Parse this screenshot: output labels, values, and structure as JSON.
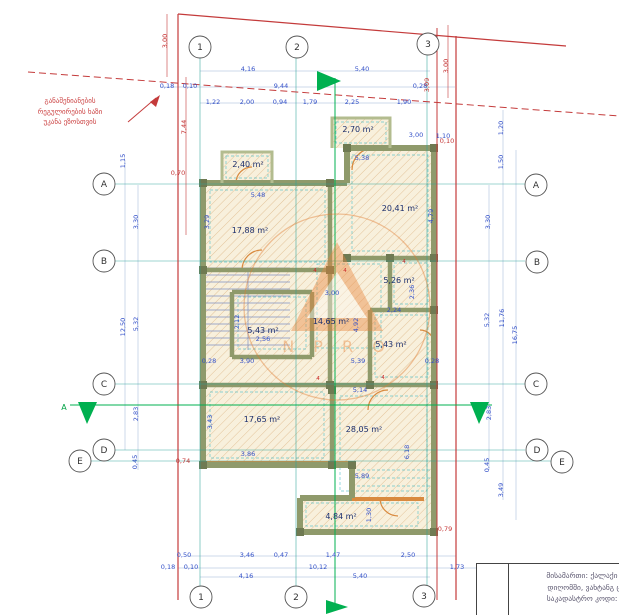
{
  "annotation": {
    "line1": "განაშენიანების",
    "line2": "რეგულირების ხაზი",
    "line3": "უკანა ეზოსთვის"
  },
  "title_block": {
    "line1": "მისამართი: ქალაქი თბილ",
    "line2": "დიღომში, ვახტანგ ცინცაძ",
    "line3": "საკადასტრო კოდი: 01.72"
  },
  "watermark": {
    "letters": "N P R O"
  },
  "section_marker": {
    "label": "A"
  },
  "colors": {
    "dimension_blue": "#3350c8",
    "room_label": "#1c2f6e",
    "boundary_red": "#c43b3b",
    "grid_teal": "#2aa198",
    "section_green": "#00b050",
    "door_orange": "#d98a3f",
    "wall_olive": "#8f9a6b",
    "watermark_orange": "#e8833a"
  },
  "grid_bubbles": [
    {
      "label": "1",
      "x": 200,
      "y": 47
    },
    {
      "label": "2",
      "x": 297,
      "y": 47
    },
    {
      "label": "3",
      "x": 428,
      "y": 44
    },
    {
      "label": "1",
      "x": 201,
      "y": 597
    },
    {
      "label": "2",
      "x": 296,
      "y": 597
    },
    {
      "label": "3",
      "x": 424,
      "y": 596
    },
    {
      "label": "A",
      "x": 104,
      "y": 184
    },
    {
      "label": "B",
      "x": 104,
      "y": 261
    },
    {
      "label": "C",
      "x": 104,
      "y": 384
    },
    {
      "label": "D",
      "x": 104,
      "y": 450
    },
    {
      "label": "E",
      "x": 80,
      "y": 461
    },
    {
      "label": "A",
      "x": 536,
      "y": 185
    },
    {
      "label": "B",
      "x": 537,
      "y": 262
    },
    {
      "label": "C",
      "x": 536,
      "y": 384
    },
    {
      "label": "D",
      "x": 537,
      "y": 450
    },
    {
      "label": "E",
      "x": 562,
      "y": 462
    }
  ],
  "room_labels": [
    {
      "t": "2,40 m²",
      "x": 248,
      "y": 167
    },
    {
      "t": "2,70 m²",
      "x": 358,
      "y": 132
    },
    {
      "t": "20,41 m²",
      "x": 400,
      "y": 211
    },
    {
      "t": "17,88 m²",
      "x": 250,
      "y": 233
    },
    {
      "t": "5,26 m²",
      "x": 399,
      "y": 283
    },
    {
      "t": "14,65 m²",
      "x": 331,
      "y": 324
    },
    {
      "t": "5,43 m²",
      "x": 263,
      "y": 333
    },
    {
      "t": "5,43 m²",
      "x": 391,
      "y": 347
    },
    {
      "t": "17,65 m²",
      "x": 262,
      "y": 422
    },
    {
      "t": "28,05 m²",
      "x": 364,
      "y": 432
    },
    {
      "t": "4,84 m²",
      "x": 341,
      "y": 519
    }
  ],
  "dimensions_blue": [
    {
      "t": "4,16",
      "x": 248,
      "y": 71
    },
    {
      "t": "5,40",
      "x": 362,
      "y": 71
    },
    {
      "t": "0,18",
      "x": 167,
      "y": 88
    },
    {
      "t": "0,10",
      "x": 190,
      "y": 88
    },
    {
      "t": "9,44",
      "x": 281,
      "y": 88
    },
    {
      "t": "0,28",
      "x": 420,
      "y": 88
    },
    {
      "t": "1,22",
      "x": 213,
      "y": 104
    },
    {
      "t": "2,00",
      "x": 247,
      "y": 104
    },
    {
      "t": "0,94",
      "x": 280,
      "y": 104
    },
    {
      "t": "1,79",
      "x": 310,
      "y": 104
    },
    {
      "t": "2,25",
      "x": 352,
      "y": 104
    },
    {
      "t": "1,90",
      "x": 404,
      "y": 104
    },
    {
      "t": "1,20",
      "x": 503,
      "y": 128,
      "r": 1
    },
    {
      "t": "1,50",
      "x": 503,
      "y": 162,
      "r": 1
    },
    {
      "t": "3,30",
      "x": 490,
      "y": 222,
      "r": 1
    },
    {
      "t": "5,32",
      "x": 489,
      "y": 320,
      "r": 1
    },
    {
      "t": "11,76",
      "x": 504,
      "y": 318,
      "r": 1
    },
    {
      "t": "16,75",
      "x": 517,
      "y": 335,
      "r": 1
    },
    {
      "t": "2,83",
      "x": 491,
      "y": 413,
      "r": 1
    },
    {
      "t": "0,45",
      "x": 489,
      "y": 465,
      "r": 1
    },
    {
      "t": "3,49",
      "x": 503,
      "y": 490,
      "r": 1
    },
    {
      "t": "1,15",
      "x": 125,
      "y": 161,
      "r": 1
    },
    {
      "t": "3,30",
      "x": 138,
      "y": 222,
      "r": 1
    },
    {
      "t": "12,50",
      "x": 125,
      "y": 327,
      "r": 1
    },
    {
      "t": "5,32",
      "x": 138,
      "y": 324,
      "r": 1
    },
    {
      "t": "2,83",
      "x": 138,
      "y": 414,
      "r": 1
    },
    {
      "t": "0,45",
      "x": 137,
      "y": 462,
      "r": 1
    },
    {
      "t": "0,50",
      "x": 184,
      "y": 557
    },
    {
      "t": "3,46",
      "x": 247,
      "y": 557
    },
    {
      "t": "0,47",
      "x": 281,
      "y": 557
    },
    {
      "t": "1,47",
      "x": 333,
      "y": 557
    },
    {
      "t": "2,50",
      "x": 408,
      "y": 557
    },
    {
      "t": "0,18",
      "x": 168,
      "y": 569
    },
    {
      "t": "0,10",
      "x": 191,
      "y": 569
    },
    {
      "t": "10,12",
      "x": 318,
      "y": 569
    },
    {
      "t": "1,73",
      "x": 457,
      "y": 569
    },
    {
      "t": "4,16",
      "x": 246,
      "y": 578
    },
    {
      "t": "5,40",
      "x": 360,
      "y": 578
    },
    {
      "t": "5,38",
      "x": 362,
      "y": 160
    },
    {
      "t": "3,00",
      "x": 416,
      "y": 137
    },
    {
      "t": "1,10",
      "x": 443,
      "y": 138
    },
    {
      "t": "5,48",
      "x": 258,
      "y": 197
    },
    {
      "t": "3,29",
      "x": 209,
      "y": 222,
      "r": 1
    },
    {
      "t": "4,79",
      "x": 433,
      "y": 216,
      "r": 1
    },
    {
      "t": "3,00",
      "x": 332,
      "y": 295
    },
    {
      "t": "2,12",
      "x": 239,
      "y": 322,
      "r": 1
    },
    {
      "t": "2,56",
      "x": 263,
      "y": 341
    },
    {
      "t": "4,92",
      "x": 358,
      "y": 325,
      "r": 1
    },
    {
      "t": "2,36",
      "x": 414,
      "y": 292,
      "r": 1
    },
    {
      "t": "2,24",
      "x": 394,
      "y": 312
    },
    {
      "t": "0,28",
      "x": 209,
      "y": 363
    },
    {
      "t": "3,90",
      "x": 247,
      "y": 363
    },
    {
      "t": "5,39",
      "x": 358,
      "y": 363
    },
    {
      "t": "0,28",
      "x": 432,
      "y": 363
    },
    {
      "t": "5,14",
      "x": 360,
      "y": 392
    },
    {
      "t": "3,43",
      "x": 212,
      "y": 422,
      "r": 1
    },
    {
      "t": "3,86",
      "x": 248,
      "y": 456
    },
    {
      "t": "5,89",
      "x": 362,
      "y": 478
    },
    {
      "t": "6,18",
      "x": 409,
      "y": 452,
      "r": 1
    },
    {
      "t": "1,30",
      "x": 371,
      "y": 515,
      "r": 1
    }
  ],
  "dimensions_red": [
    {
      "t": "3,00",
      "x": 167,
      "y": 41,
      "r": 1
    },
    {
      "t": "7,44",
      "x": 186,
      "y": 127,
      "r": 1
    },
    {
      "t": "0,70",
      "x": 178,
      "y": 175
    },
    {
      "t": "3,00",
      "x": 448,
      "y": 66,
      "r": 1
    },
    {
      "t": "3,09",
      "x": 429,
      "y": 85,
      "r": 1
    },
    {
      "t": "0,10",
      "x": 447,
      "y": 143
    },
    {
      "t": "0,74",
      "x": 183,
      "y": 463
    },
    {
      "t": "0,79",
      "x": 445,
      "y": 531
    }
  ],
  "door_tags": [
    {
      "t": "4",
      "x": 315,
      "y": 272
    },
    {
      "t": "4",
      "x": 345,
      "y": 272
    },
    {
      "t": "4",
      "x": 404,
      "y": 263
    },
    {
      "t": "4",
      "x": 318,
      "y": 380
    },
    {
      "t": "4",
      "x": 383,
      "y": 379
    }
  ]
}
